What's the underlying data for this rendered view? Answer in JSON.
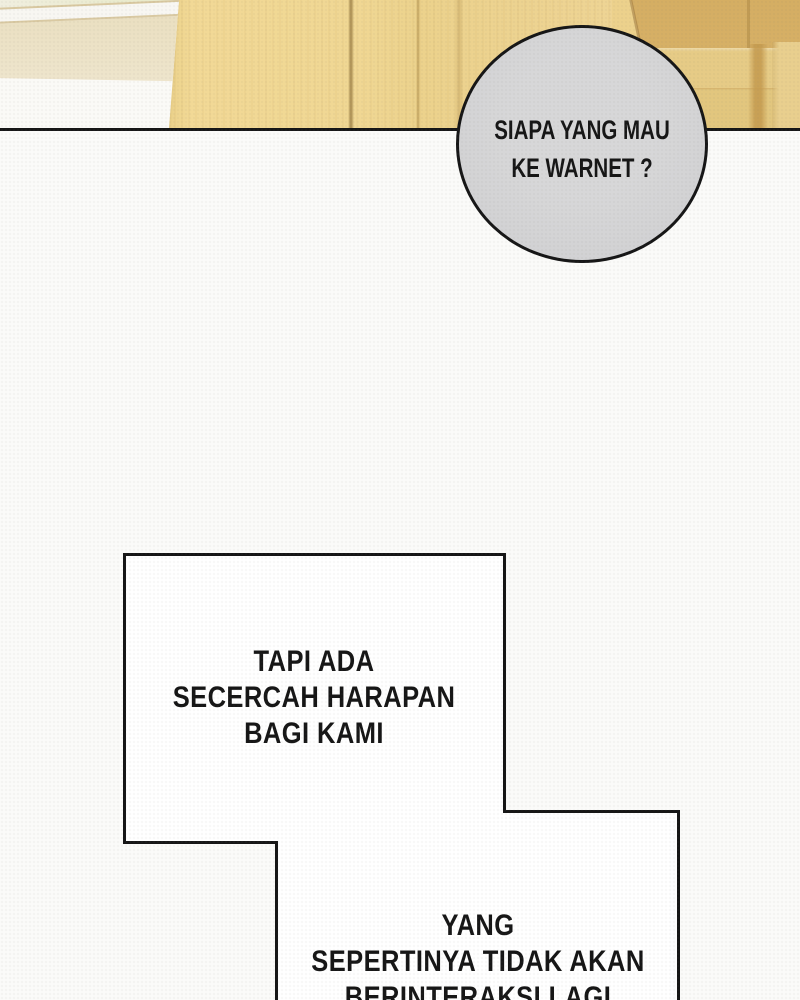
{
  "bubbles": {
    "circle": {
      "lines": [
        "SIAPA YANG MAU",
        "KE WARNET ?"
      ]
    },
    "hope_box": {
      "lines": [
        "TAPI ADA",
        "SECERCAH HARAPAN",
        "BAGI KAMI"
      ]
    },
    "interact_box": {
      "lines": [
        "YANG",
        "SEPERTINYA TIDAK AKAN",
        "BERINTERAKSI LAGI"
      ]
    }
  },
  "colors": {
    "paper": "#fbfbf9",
    "ink": "#161616",
    "bubble_gray": "#d3d3d5",
    "bubble_white": "#ffffff",
    "wood_light": "#f1d793",
    "wood_mid": "#d7b168",
    "wood_band": "#e5c983",
    "wood_streak": "#c49a4e",
    "stripe_white": "#f8f7f2",
    "stripe_beige": "#ece2c5",
    "stripe_green": "#e7e9c4",
    "stripe_line": "#d8c8a0"
  }
}
